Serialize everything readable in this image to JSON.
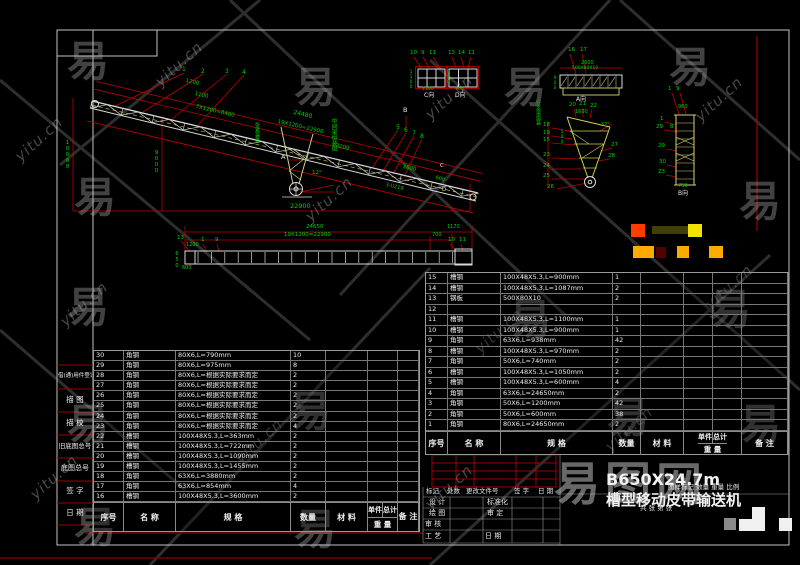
{
  "watermarks": {
    "site": "yitu.cn",
    "logo": "易",
    "brand": "易图网",
    "logo_positions": [
      [
        88,
        52
      ],
      [
        315,
        78
      ],
      [
        525,
        78
      ],
      [
        690,
        58
      ],
      [
        95,
        188
      ],
      [
        760,
        192
      ],
      [
        88,
        298
      ],
      [
        530,
        310
      ],
      [
        730,
        300
      ],
      [
        88,
        415
      ],
      [
        310,
        402
      ],
      [
        628,
        408
      ],
      [
        760,
        415
      ],
      [
        95,
        518
      ],
      [
        315,
        520
      ]
    ],
    "site_positions": [
      [
        10,
        130
      ],
      [
        150,
        55
      ],
      [
        420,
        88
      ],
      [
        690,
        90
      ],
      [
        55,
        295
      ],
      [
        300,
        190
      ],
      [
        470,
        322
      ],
      [
        700,
        278
      ],
      [
        25,
        468
      ],
      [
        230,
        432
      ],
      [
        420,
        478
      ],
      [
        600,
        420
      ]
    ]
  },
  "sidebar": {
    "items": [
      "借(通)用件登记",
      "描  图",
      "描  校",
      "旧底图总号",
      "底图总号",
      "签  字",
      "日  期"
    ]
  },
  "tables": {
    "header": {
      "no": "序号",
      "name": "名  称",
      "spec": "规  格",
      "qty": "数量",
      "mat": "材  料",
      "unit": "单件",
      "total": "总计",
      "weight": "重 量",
      "note": "备 注"
    },
    "right_rows": [
      [
        "15",
        "槽钢",
        "100X48X5.3,L=900mm",
        "1"
      ],
      [
        "14",
        "槽钢",
        "100X48X5.3,L=1087mm",
        "2"
      ],
      [
        "13",
        "钢板",
        "500X80X10",
        "2"
      ],
      [
        "12",
        "",
        "",
        ""
      ],
      [
        "11",
        "槽钢",
        "100X48X5.3,L=1100mm",
        "1"
      ],
      [
        "10",
        "槽钢",
        "100X48X5.3,L=900mm",
        "1"
      ],
      [
        "9",
        "角钢",
        "63X6,L=938mm",
        "42"
      ],
      [
        "8",
        "槽钢",
        "100X48X5.3,L=970mm",
        "2"
      ],
      [
        "7",
        "角钢",
        "50X6,L=740mm",
        "2"
      ],
      [
        "6",
        "槽钢",
        "100X48X5.3,L=1050mm",
        "2"
      ],
      [
        "5",
        "槽钢",
        "100X48X5.3,L=600mm",
        "4"
      ],
      [
        "4",
        "角钢",
        "63X6,L=24650mm",
        "2"
      ],
      [
        "3",
        "角钢",
        "50X6,L=1200mm",
        "42"
      ],
      [
        "2",
        "角钢",
        "50X6,L=600mm",
        "38"
      ],
      [
        "1",
        "角钢",
        "80X6,L=24650mm",
        "2"
      ]
    ],
    "left_rows": [
      [
        "30",
        "角钢",
        "80X6,L=790mm",
        "10"
      ],
      [
        "29",
        "角钢",
        "80X6,L=975mm",
        "8"
      ],
      [
        "28",
        "角钢",
        "80X6,L=根据实际要求而定",
        "2"
      ],
      [
        "27",
        "角钢",
        "80X6,L=根据实际要求而定",
        "2"
      ],
      [
        "26",
        "角钢",
        "80X6,L=根据实际要求而定",
        "2"
      ],
      [
        "25",
        "角钢",
        "80X6,L=根据实际要求而定",
        "2"
      ],
      [
        "24",
        "角钢",
        "80X6,L=根据实际要求而定",
        "2"
      ],
      [
        "23",
        "角钢",
        "80X6,L=根据实际要求而定",
        "4"
      ],
      [
        "22",
        "槽钢",
        "100X48X5.3,L=363mm",
        "2"
      ],
      [
        "21",
        "槽钢",
        "100X48X5.3,L=722mm",
        "2"
      ],
      [
        "20",
        "槽钢",
        "100X48X5.3,L=1090mm",
        "2"
      ],
      [
        "19",
        "槽钢",
        "100X48X5.3,L=1455mm",
        "2"
      ],
      [
        "18",
        "角钢",
        "63X6,L=3880mm",
        "2"
      ],
      [
        "17",
        "角钢",
        "63X6,L=854mm",
        "4"
      ],
      [
        "16",
        "槽钢",
        "100X48X5.3,L=3600mm",
        "2"
      ]
    ]
  },
  "title_block": {
    "rev_cells": [
      "标记",
      "处数",
      "更改文件号",
      "签 字",
      "日 期"
    ],
    "roles": [
      "设 计",
      "标准化",
      "绘 图",
      "审 定",
      "审 核",
      "工 艺",
      "日 期"
    ],
    "title1": "B650X24.7m",
    "title2": "槽型移动皮带输送机",
    "info_row": "图样标记  数量  重量  比例",
    "sheet": "共  张  第  张"
  },
  "colors": {
    "orange_red": "#ff3c00",
    "olive": "#3f3f06",
    "yellow": "#f2e400",
    "orange": "#ffaa00",
    "dark_red": "#550000",
    "gray_patch": "#8a8a8a",
    "white_patch": "#f0f0f0",
    "dim_red": "#c00000",
    "cad_green": "#00d400",
    "line_white": "#d9d9d9"
  },
  "annotations": [
    {
      "t": "1",
      "x": 182,
      "y": 67
    },
    {
      "t": "2",
      "x": 201,
      "y": 69
    },
    {
      "t": "3",
      "x": 225,
      "y": 69
    },
    {
      "t": "4",
      "x": 242,
      "y": 70
    },
    {
      "t": "5",
      "x": 396,
      "y": 125
    },
    {
      "t": "6",
      "x": 404,
      "y": 128
    },
    {
      "t": "7",
      "x": 412,
      "y": 131
    },
    {
      "t": "8",
      "x": 420,
      "y": 134
    },
    {
      "t": "1200",
      "x": 186,
      "y": 79,
      "r": 13,
      "s": 5.5
    },
    {
      "t": "1100",
      "x": 195,
      "y": 92,
      "r": 13,
      "s": 5.5
    },
    {
      "t": "7X1200=8400",
      "x": 196,
      "y": 105,
      "r": 13,
      "s": 5.5
    },
    {
      "t": "24480",
      "x": 294,
      "y": 110,
      "r": 13,
      "s": 6
    },
    {
      "t": "19X1200=22900",
      "x": 278,
      "y": 120,
      "r": 13,
      "s": 5.5
    },
    {
      "t": "3200",
      "x": 336,
      "y": 144,
      "r": 13,
      "s": 5.5
    },
    {
      "t": "1600",
      "x": 403,
      "y": 165,
      "r": 13,
      "s": 5.5
    },
    {
      "t": "600",
      "x": 436,
      "y": 176,
      "r": 13,
      "s": 5
    },
    {
      "t": "3-U219",
      "x": 386,
      "y": 183,
      "r": 13,
      "s": 5
    },
    {
      "t": "12°",
      "x": 312,
      "y": 171,
      "s": 5.5
    },
    {
      "t": "22900",
      "x": 290,
      "y": 203,
      "s": 6.5
    },
    {
      "t": "10000",
      "x": 64,
      "y": 140,
      "v": 1,
      "s": 5.5
    },
    {
      "t": "9000",
      "x": 153,
      "y": 150,
      "v": 1,
      "s": 5.5
    },
    {
      "t": "B",
      "x": 403,
      "y": 107,
      "c": "w",
      "s": 6.5
    },
    {
      "t": "A",
      "x": 281,
      "y": 154,
      "c": "w",
      "s": 6.5
    },
    {
      "t": "C",
      "x": 440,
      "y": 164,
      "c": "w",
      "s": 5.5
    },
    {
      "t": "D",
      "x": 442,
      "y": 188,
      "c": "w",
      "s": 5.5
    },
    {
      "t": "中间架组装图",
      "x": 330,
      "y": 118,
      "v": 1,
      "s": 5.5
    },
    {
      "t": "张紧装置",
      "x": 254,
      "y": 122,
      "v": 1,
      "s": 5
    },
    {
      "t": "24650",
      "x": 306,
      "y": 225,
      "s": 5.5
    },
    {
      "t": "19X1200=22900",
      "x": 284,
      "y": 233,
      "s": 5.5
    },
    {
      "t": "1170",
      "x": 447,
      "y": 225,
      "s": 5
    },
    {
      "t": "700",
      "x": 432,
      "y": 233,
      "s": 5
    },
    {
      "t": "13",
      "x": 177,
      "y": 236,
      "s": 5.5
    },
    {
      "t": "1",
      "x": 201,
      "y": 238,
      "s": 5.5
    },
    {
      "t": "9",
      "x": 215,
      "y": 238,
      "s": 5.5
    },
    {
      "t": "10",
      "x": 448,
      "y": 238,
      "s": 5.5
    },
    {
      "t": "11",
      "x": 459,
      "y": 238,
      "s": 5.5
    },
    {
      "t": "1200",
      "x": 186,
      "y": 243,
      "s": 5
    },
    {
      "t": "650",
      "x": 174,
      "y": 251,
      "v": 1,
      "s": 5
    },
    {
      "t": "600",
      "x": 182,
      "y": 266,
      "s": 5
    },
    {
      "t": "10",
      "x": 410,
      "y": 51,
      "s": 5.5
    },
    {
      "t": "9",
      "x": 421,
      "y": 51,
      "s": 5.5
    },
    {
      "t": "11",
      "x": 429,
      "y": 51,
      "s": 5.5
    },
    {
      "t": "13",
      "x": 448,
      "y": 51,
      "s": 5.5
    },
    {
      "t": "14",
      "x": 458,
      "y": 51,
      "s": 5.5
    },
    {
      "t": "11",
      "x": 468,
      "y": 51,
      "s": 5.5
    },
    {
      "t": "1100",
      "x": 408,
      "y": 70,
      "v": 1,
      "s": 4.5
    },
    {
      "t": "900",
      "x": 445,
      "y": 70,
      "v": 1,
      "s": 4.5
    },
    {
      "t": "1100",
      "x": 422,
      "y": 88,
      "s": 4.5
    },
    {
      "t": "900",
      "x": 455,
      "y": 88,
      "s": 4.5
    },
    {
      "t": "C向",
      "x": 424,
      "y": 93,
      "c": "w",
      "s": 6
    },
    {
      "t": "D向",
      "x": 455,
      "y": 93,
      "c": "w",
      "s": 6
    },
    {
      "t": "16",
      "x": 568,
      "y": 48,
      "s": 5.5
    },
    {
      "t": "17",
      "x": 580,
      "y": 48,
      "s": 5.5
    },
    {
      "t": "2600",
      "x": 581,
      "y": 61,
      "s": 5
    },
    {
      "t": "500X80X10",
      "x": 572,
      "y": 67,
      "s": 4.5
    },
    {
      "t": "900",
      "x": 552,
      "y": 76,
      "v": 1,
      "s": 4.5
    },
    {
      "t": "A向",
      "x": 576,
      "y": 97,
      "c": "w",
      "s": 6
    },
    {
      "t": "20",
      "x": 569,
      "y": 103,
      "s": 5.5
    },
    {
      "t": "21",
      "x": 579,
      "y": 102,
      "s": 5.5
    },
    {
      "t": "22",
      "x": 590,
      "y": 104,
      "s": 5.5
    },
    {
      "t": "1600",
      "x": 575,
      "y": 110,
      "s": 5
    },
    {
      "t": "500",
      "x": 559,
      "y": 130,
      "v": 1,
      "s": 4.5
    },
    {
      "t": "18",
      "x": 543,
      "y": 123,
      "s": 5.5
    },
    {
      "t": "19",
      "x": 543,
      "y": 131,
      "s": 5.5
    },
    {
      "t": "15",
      "x": 543,
      "y": 138,
      "s": 5.5
    },
    {
      "t": "23",
      "x": 543,
      "y": 153,
      "s": 5.5
    },
    {
      "t": "24",
      "x": 543,
      "y": 164,
      "s": 5.5
    },
    {
      "t": "25",
      "x": 543,
      "y": 174,
      "s": 5.5
    },
    {
      "t": "26",
      "x": 547,
      "y": 185,
      "s": 5.5
    },
    {
      "t": "27",
      "x": 611,
      "y": 143,
      "s": 5.5
    },
    {
      "t": "28",
      "x": 608,
      "y": 154,
      "s": 5.5
    },
    {
      "t": "32°",
      "x": 601,
      "y": 123,
      "s": 5
    },
    {
      "t": "行走架组装",
      "x": 535,
      "y": 100,
      "v": 1,
      "s": 5
    },
    {
      "t": "1",
      "x": 668,
      "y": 87,
      "s": 5.5
    },
    {
      "t": "9",
      "x": 676,
      "y": 87,
      "s": 5.5
    },
    {
      "t": "960",
      "x": 678,
      "y": 105,
      "s": 5
    },
    {
      "t": "1",
      "x": 660,
      "y": 117,
      "s": 5.5
    },
    {
      "t": "29",
      "x": 656,
      "y": 125,
      "s": 5.5
    },
    {
      "t": "8",
      "x": 670,
      "y": 125,
      "s": 5.5
    },
    {
      "t": "29",
      "x": 658,
      "y": 144,
      "s": 5.5
    },
    {
      "t": "30",
      "x": 659,
      "y": 160,
      "s": 5.5
    },
    {
      "t": "23",
      "x": 658,
      "y": 170,
      "s": 5.5
    },
    {
      "t": "790",
      "x": 678,
      "y": 184,
      "s": 5
    },
    {
      "t": "B向",
      "x": 678,
      "y": 191,
      "c": "w",
      "s": 6
    }
  ]
}
